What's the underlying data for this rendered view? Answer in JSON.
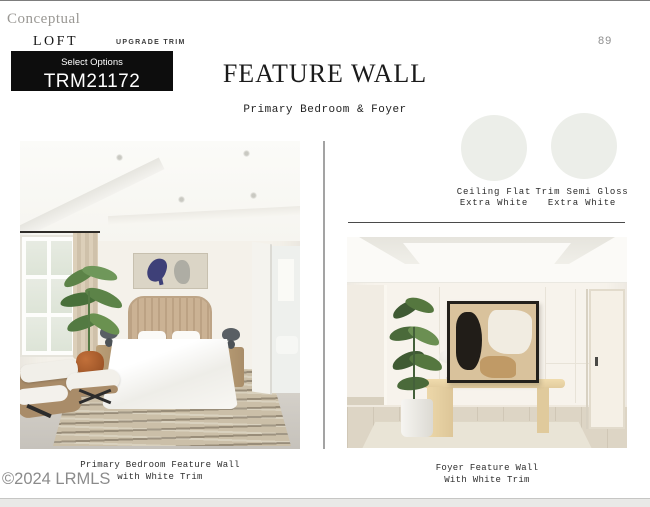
{
  "header": {
    "conceptual": "Conceptual",
    "collection": "LOFT",
    "upgrade": "UPGRADE TRIM",
    "select_options": "Select Options",
    "option_code": "TRM21172",
    "title": "FEATURE WALL",
    "subtitle": "Primary Bedroom & Foyer",
    "page_number": "89"
  },
  "swatches": [
    {
      "label_line1": "Ceiling Flat",
      "label_line2": "Extra White",
      "color": "#ECEEE9"
    },
    {
      "label_line1": "Trim Semi Gloss",
      "label_line2": "Extra White",
      "color": "#ECEEE9"
    }
  ],
  "photos": {
    "bedroom": {
      "caption_line1": "Primary Bedroom Feature Wall",
      "caption_line2": "with White Trim"
    },
    "foyer": {
      "caption_line1": "Foyer Feature Wall",
      "caption_line2": "With White Trim"
    }
  },
  "watermark": "©2024 LRMLS",
  "colors": {
    "select_box_bg": "#0D0D0D",
    "footer_band": "#E9E9E7",
    "vertical_divider": "#A3A3A3",
    "horizontal_rule": "#4A4A4A"
  }
}
